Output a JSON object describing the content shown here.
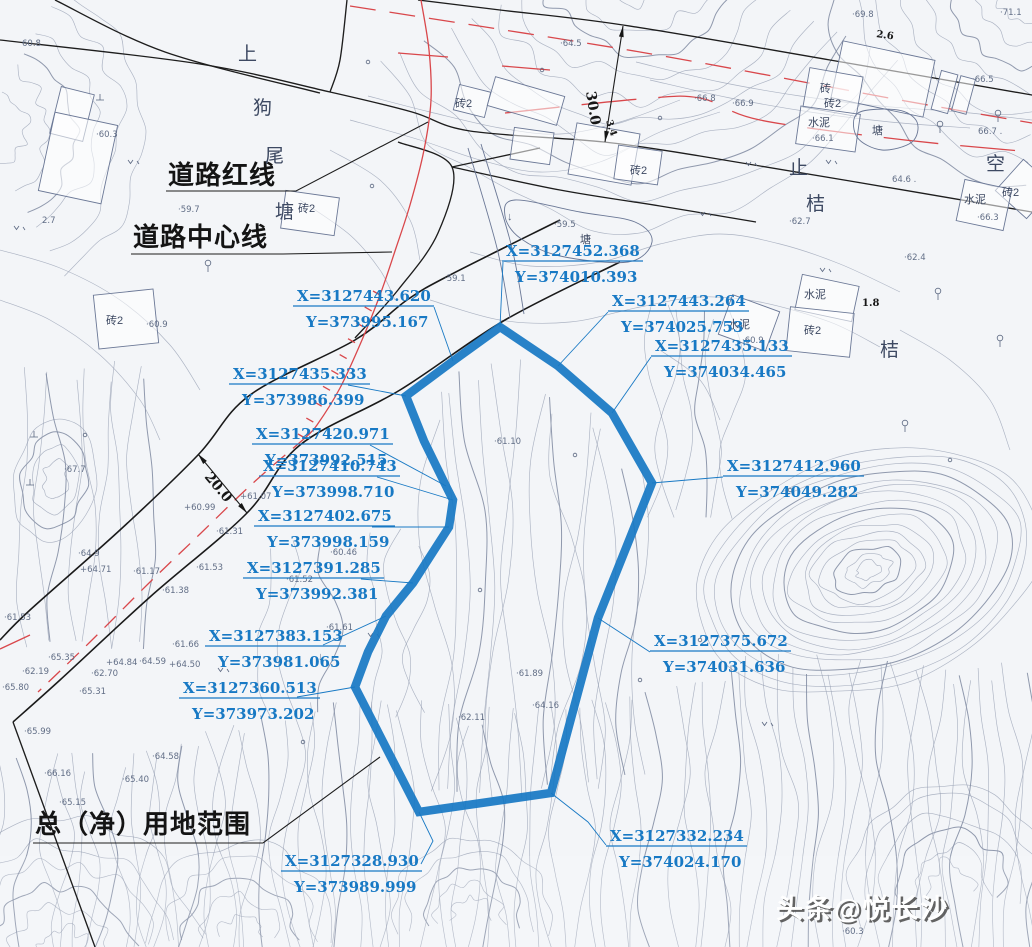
{
  "colors": {
    "accent_blue": "#1879c4",
    "red_line": "#d9474b",
    "black_line": "#1d1d1d",
    "contour": "#97a0b4"
  },
  "legend": {
    "road_red_line": "道路红线",
    "road_center_line": "道路中心线",
    "land_use_scope": "总（净）用地范围"
  },
  "place_name": [
    {
      "t": "上",
      "x": 238,
      "y": 60
    },
    {
      "t": "狗",
      "x": 253,
      "y": 114
    },
    {
      "t": "尾",
      "x": 265,
      "y": 162
    },
    {
      "t": "塘",
      "x": 275,
      "y": 218
    }
  ],
  "side_labels": [
    {
      "t": "止",
      "x": 789,
      "y": 174,
      "fs": 15
    },
    {
      "t": "桔",
      "x": 806,
      "y": 210,
      "fs": 15
    },
    {
      "t": "桔",
      "x": 880,
      "y": 356,
      "fs": 16
    },
    {
      "t": "空",
      "x": 986,
      "y": 170,
      "fs": 15
    }
  ],
  "watermark": "头条@悦长沙",
  "boundary": {
    "points": [
      [
        500,
        327
      ],
      [
        558,
        366
      ],
      [
        612,
        413
      ],
      [
        652,
        483
      ],
      [
        598,
        618
      ],
      [
        551,
        793
      ],
      [
        419,
        812
      ],
      [
        355,
        687
      ],
      [
        368,
        652
      ],
      [
        386,
        616
      ],
      [
        413,
        583
      ],
      [
        449,
        527
      ],
      [
        453,
        500
      ],
      [
        446,
        486
      ],
      [
        424,
        441
      ],
      [
        406,
        396
      ],
      [
        453,
        361
      ]
    ]
  },
  "coordinate_labels": [
    {
      "X": "X=3127452.368",
      "Y": "Y=374010.393",
      "x": 506,
      "y": 256,
      "leader": [
        [
          503,
          262
        ],
        [
          500,
          327
        ]
      ]
    },
    {
      "X": "X=3127443.620",
      "Y": "Y=373995.167",
      "x": 297,
      "y": 301,
      "leader": [
        [
          434,
          307
        ],
        [
          453,
          361
        ]
      ]
    },
    {
      "X": "X=3127443.264",
      "Y": "Y=374025.753",
      "x": 612,
      "y": 306,
      "leader": [
        [
          608,
          312
        ],
        [
          558,
          366
        ]
      ]
    },
    {
      "X": "X=3127435.133",
      "Y": "Y=374034.465",
      "x": 655,
      "y": 351,
      "leader": [
        [
          651,
          357
        ],
        [
          612,
          413
        ]
      ]
    },
    {
      "X": "X=3127435.333",
      "Y": "Y=373986.399",
      "x": 233,
      "y": 379,
      "leader": [
        [
          348,
          385
        ],
        [
          406,
          396
        ]
      ]
    },
    {
      "X": "X=3127420.971",
      "Y": "Y=373992.515",
      "x": 256,
      "y": 439,
      "leader": [
        [
          370,
          445
        ],
        [
          446,
          486
        ]
      ]
    },
    {
      "X": "X=3127410.743",
      "Y": "Y=373998.710",
      "x": 263,
      "y": 471,
      "leader": [
        [
          377,
          477
        ],
        [
          453,
          500
        ]
      ]
    },
    {
      "X": "X=3127402.675",
      "Y": "Y=373998.159",
      "x": 258,
      "y": 521,
      "leader": [
        [
          372,
          527
        ],
        [
          449,
          527
        ]
      ]
    },
    {
      "X": "X=3127391.285",
      "Y": "Y=373992.381",
      "x": 247,
      "y": 573,
      "leader": [
        [
          361,
          579
        ],
        [
          413,
          583
        ]
      ]
    },
    {
      "X": "X=3127412.960",
      "Y": "Y=374049.282",
      "x": 727,
      "y": 471,
      "leader": [
        [
          723,
          477
        ],
        [
          652,
          483
        ]
      ]
    },
    {
      "X": "X=3127383.153",
      "Y": "Y=373981.065",
      "x": 209,
      "y": 641,
      "leader": [
        [
          323,
          645
        ],
        [
          386,
          616
        ]
      ]
    },
    {
      "X": "X=3127360.513",
      "Y": "Y=373973.202",
      "x": 183,
      "y": 693,
      "leader": [
        [
          297,
          697
        ],
        [
          355,
          687
        ]
      ]
    },
    {
      "X": "X=3127375.672",
      "Y": "Y=374031.636",
      "x": 654,
      "y": 646,
      "leader": [
        [
          650,
          652
        ],
        [
          598,
          618
        ]
      ]
    },
    {
      "X": "X=3127328.930",
      "Y": "Y=373989.999",
      "x": 285,
      "y": 866,
      "leader": [
        [
          421,
          864
        ],
        [
          433,
          841
        ],
        [
          419,
          812
        ]
      ]
    },
    {
      "X": "X=3127332.234",
      "Y": "Y=374024.170",
      "x": 610,
      "y": 841,
      "leader": [
        [
          606,
          845
        ],
        [
          588,
          822
        ],
        [
          551,
          793
        ]
      ]
    }
  ],
  "dimensions": [
    {
      "text": "30.0",
      "line": [
        [
          623,
          26
        ],
        [
          605,
          142
        ]
      ],
      "tx": 586,
      "ty": 92,
      "rot": 81,
      "fs": 14
    },
    {
      "text": "20.0",
      "line": [
        [
          198,
          454
        ],
        [
          247,
          513
        ]
      ],
      "tx": 204,
      "ty": 477,
      "rot": 50,
      "fs": 14
    },
    {
      "text": "3.4",
      "tx": 606,
      "ty": 121,
      "rot": 72,
      "fs": 9.5
    },
    {
      "text": "1.8",
      "tx": 862,
      "ty": 306,
      "rot": 0,
      "fs": 10
    },
    {
      "text": "2.6",
      "tx": 876,
      "ty": 37,
      "rot": 8,
      "fs": 10
    }
  ],
  "spot_elevations": [
    {
      "x": 22,
      "y": 46,
      "t": "60.8"
    },
    {
      "x": 96,
      "y": 137,
      "t": "·60.3"
    },
    {
      "x": 178,
      "y": 212,
      "t": "·59.7"
    },
    {
      "x": 42,
      "y": 223,
      "t": "2.7"
    },
    {
      "x": 146,
      "y": 327,
      "t": "·60.9"
    },
    {
      "x": 444,
      "y": 281,
      "t": "·59.1"
    },
    {
      "x": 554,
      "y": 227,
      "t": "·59.5"
    },
    {
      "x": 560,
      "y": 46,
      "t": "·64.5"
    },
    {
      "x": 852,
      "y": 17,
      "t": "·69.8"
    },
    {
      "x": 1000,
      "y": 15,
      "t": "·71.1"
    },
    {
      "x": 694,
      "y": 101,
      "t": "·66.8"
    },
    {
      "x": 732,
      "y": 106,
      "t": "·66.9"
    },
    {
      "x": 972,
      "y": 82,
      "t": "·66.5"
    },
    {
      "x": 978,
      "y": 134,
      "t": "66.7 ."
    },
    {
      "x": 812,
      "y": 141,
      "t": "·66.1"
    },
    {
      "x": 977,
      "y": 220,
      "t": "·66.3"
    },
    {
      "x": 892,
      "y": 182,
      "t": "64.6 ."
    },
    {
      "x": 789,
      "y": 224,
      "t": "·62.7"
    },
    {
      "x": 904,
      "y": 260,
      "t": "·62.4"
    },
    {
      "x": 742,
      "y": 343,
      "t": "·60.9"
    },
    {
      "x": 64,
      "y": 472,
      "t": "·67.7"
    },
    {
      "x": 78,
      "y": 556,
      "t": "·64.9"
    },
    {
      "x": 80,
      "y": 572,
      "t": "+64.71"
    },
    {
      "x": 133,
      "y": 574,
      "t": "·61.17"
    },
    {
      "x": 240,
      "y": 499,
      "t": "+61.07"
    },
    {
      "x": 184,
      "y": 510,
      "t": "+60.99"
    },
    {
      "x": 216,
      "y": 534,
      "t": "·61.31"
    },
    {
      "x": 196,
      "y": 570,
      "t": "·61.53"
    },
    {
      "x": 162,
      "y": 593,
      "t": "·61.38"
    },
    {
      "x": 4,
      "y": 620,
      "t": "·61.53"
    },
    {
      "x": 286,
      "y": 582,
      "t": "·61.52"
    },
    {
      "x": 330,
      "y": 555,
      "t": "·60.46"
    },
    {
      "x": 172,
      "y": 647,
      "t": "·61.66"
    },
    {
      "x": 106,
      "y": 665,
      "t": "+64.84"
    },
    {
      "x": 139,
      "y": 664,
      "t": "·64.59"
    },
    {
      "x": 169,
      "y": 667,
      "t": "+64.50"
    },
    {
      "x": 48,
      "y": 660,
      "t": "·65.35"
    },
    {
      "x": 2,
      "y": 690,
      "t": "·65.80"
    },
    {
      "x": 79,
      "y": 694,
      "t": "·65.31"
    },
    {
      "x": 24,
      "y": 734,
      "t": "·65.99"
    },
    {
      "x": 44,
      "y": 776,
      "t": "·66.16"
    },
    {
      "x": 152,
      "y": 759,
      "t": "·64.58"
    },
    {
      "x": 122,
      "y": 782,
      "t": "·65.40"
    },
    {
      "x": 59,
      "y": 805,
      "t": "·65.15"
    },
    {
      "x": 326,
      "y": 630,
      "t": "·61.61"
    },
    {
      "x": 516,
      "y": 676,
      "t": "·61.89"
    },
    {
      "x": 458,
      "y": 720,
      "t": "·62.11"
    },
    {
      "x": 22,
      "y": 674,
      "t": "·62.19"
    },
    {
      "x": 91,
      "y": 676,
      "t": "·62.70"
    },
    {
      "x": 532,
      "y": 708,
      "t": "·64.16"
    },
    {
      "x": 494,
      "y": 444,
      "t": "·61.10"
    },
    {
      "x": 842,
      "y": 934,
      "t": "·60.3"
    }
  ],
  "feature_labels": [
    {
      "t": "塘",
      "x": 872,
      "y": 134,
      "fs": 13
    },
    {
      "t": "塘",
      "x": 580,
      "y": 243,
      "fs": 13
    },
    {
      "t": "砖",
      "x": 820,
      "y": 92,
      "fs": 11
    },
    {
      "t": "砖2",
      "x": 824,
      "y": 107,
      "fs": 11
    },
    {
      "t": "砖2",
      "x": 455,
      "y": 107,
      "fs": 11
    },
    {
      "t": "砖2",
      "x": 630,
      "y": 174,
      "fs": 11
    },
    {
      "t": "砖2",
      "x": 1002,
      "y": 196,
      "fs": 11
    },
    {
      "t": "砖2",
      "x": 298,
      "y": 212,
      "fs": 11
    },
    {
      "t": "砖2",
      "x": 106,
      "y": 324,
      "fs": 11
    },
    {
      "t": "水泥",
      "x": 808,
      "y": 126,
      "fs": 11
    },
    {
      "t": "水泥",
      "x": 964,
      "y": 203,
      "fs": 11
    },
    {
      "t": "水泥",
      "x": 728,
      "y": 328,
      "fs": 11
    },
    {
      "t": "水泥",
      "x": 804,
      "y": 298,
      "fs": 11
    },
    {
      "t": "砖2",
      "x": 804,
      "y": 334,
      "fs": 11
    }
  ],
  "symbols": {
    "trees": [
      [
        940,
        129
      ],
      [
        998,
        118
      ],
      [
        938,
        296
      ],
      [
        1000,
        343
      ],
      [
        905,
        428
      ],
      [
        208,
        268
      ]
    ],
    "grass": [
      [
        128,
        160
      ],
      [
        14,
        226
      ],
      [
        746,
        162
      ],
      [
        700,
        212
      ],
      [
        820,
        268
      ],
      [
        368,
        633
      ],
      [
        218,
        668
      ],
      [
        762,
        722
      ],
      [
        826,
        160
      ]
    ],
    "arrows": [
      [
        507,
        220
      ],
      [
        318,
        660
      ]
    ],
    "tmarks": [
      [
        100,
        100
      ],
      [
        34,
        437
      ],
      [
        30,
        485
      ]
    ],
    "dots": [
      [
        368,
        62
      ],
      [
        542,
        70
      ],
      [
        372,
        186
      ],
      [
        85,
        435
      ],
      [
        660,
        118
      ],
      [
        303,
        742
      ],
      [
        575,
        455
      ],
      [
        640,
        680
      ],
      [
        950,
        460
      ],
      [
        790,
        490
      ],
      [
        480,
        590
      ],
      [
        700,
        640
      ]
    ]
  },
  "map_lines": {
    "black": [
      [
        [
          0,
          40
        ],
        [
          200,
          64
        ],
        [
          330,
          92
        ],
        [
          412,
          112
        ],
        [
          470,
          131
        ],
        [
          604,
          142
        ],
        [
          700,
          156
        ],
        [
          850,
          181
        ],
        [
          1032,
          212
        ]
      ],
      [
        [
          418,
          0
        ],
        [
          500,
          10
        ],
        [
          623,
          25
        ],
        [
          830,
          60
        ],
        [
          1032,
          95
        ]
      ],
      [
        [
          55,
          0
        ],
        [
          165,
          52
        ],
        [
          320,
          93
        ]
      ],
      [
        [
          347,
          0
        ],
        [
          340,
          60
        ],
        [
          330,
          92
        ]
      ],
      [
        [
          398,
          142
        ],
        [
          452,
          167
        ],
        [
          438,
          233
        ],
        [
          398,
          290
        ],
        [
          355,
          338
        ]
      ],
      [
        [
          452,
          167
        ],
        [
          540,
          148
        ]
      ],
      [
        [
          452,
          167
        ],
        [
          560,
          190
        ],
        [
          660,
          206
        ],
        [
          756,
          222
        ]
      ],
      [
        [
          560,
          220
        ],
        [
          450,
          275
        ],
        [
          407,
          300
        ],
        [
          355,
          340
        ],
        [
          250,
          395
        ],
        [
          198,
          455
        ],
        [
          120,
          530
        ],
        [
          30,
          610
        ],
        [
          0,
          640
        ]
      ],
      [
        [
          620,
          262
        ],
        [
          505,
          320
        ],
        [
          400,
          390
        ],
        [
          300,
          445
        ],
        [
          247,
          513
        ],
        [
          150,
          597
        ],
        [
          60,
          680
        ],
        [
          13,
          722
        ]
      ],
      [
        [
          13,
          722
        ],
        [
          95,
          947
        ]
      ]
    ],
    "red": [
      {
        "pts": [
          [
            350,
            6
          ],
          [
            640,
            52
          ],
          [
            900,
            100
          ],
          [
            1032,
            123
          ]
        ],
        "dash": "26 14"
      },
      {
        "pts": [
          [
            505,
            113
          ],
          [
            640,
            99
          ],
          [
            700,
            98
          ],
          [
            760,
            120
          ],
          [
            905,
            140
          ],
          [
            1032,
            152
          ]
        ],
        "dash": "55 22"
      },
      {
        "pts": [
          [
            421,
            0
          ],
          [
            429,
            50
          ],
          [
            431,
            100
          ],
          [
            424,
            150
          ],
          [
            410,
            205
          ],
          [
            396,
            248
          ],
          [
            380,
            295
          ],
          [
            362,
            340
          ],
          [
            340,
            388
          ],
          [
            317,
            425
          ],
          [
            305,
            438
          ]
        ],
        "dash": ""
      },
      {
        "pts": [
          [
            305,
            438
          ],
          [
            252,
            484
          ],
          [
            200,
            534
          ],
          [
            148,
            584
          ],
          [
            90,
            642
          ],
          [
            38,
            692
          ]
        ],
        "dash": "16 10"
      },
      {
        "pts": [
          [
            398,
            53
          ],
          [
            448,
            57
          ]
        ],
        "dash": ""
      },
      {
        "pts": [
          [
            502,
            66
          ],
          [
            550,
            70
          ]
        ],
        "dash": ""
      },
      {
        "pts": [
          [
            0,
            649
          ],
          [
            30,
            635
          ]
        ],
        "dash": ""
      }
    ]
  },
  "buildings": [
    [
      55,
      90,
      34,
      48,
      14
    ],
    [
      46,
      118,
      64,
      80,
      12
    ],
    [
      96,
      292,
      60,
      54,
      -6
    ],
    [
      283,
      194,
      54,
      38,
      8
    ],
    [
      456,
      88,
      32,
      26,
      14
    ],
    [
      490,
      86,
      72,
      30,
      16
    ],
    [
      512,
      130,
      40,
      32,
      8
    ],
    [
      572,
      128,
      64,
      52,
      10
    ],
    [
      616,
      148,
      44,
      34,
      8
    ],
    [
      836,
      50,
      94,
      58,
      12
    ],
    [
      806,
      72,
      54,
      40,
      10
    ],
    [
      798,
      110,
      60,
      38,
      8
    ],
    [
      936,
      72,
      17,
      40,
      15
    ],
    [
      956,
      77,
      15,
      36,
      15
    ],
    [
      1004,
      168,
      42,
      42,
      42
    ],
    [
      960,
      184,
      48,
      42,
      12
    ],
    [
      798,
      280,
      58,
      36,
      12
    ],
    [
      788,
      310,
      64,
      44,
      6
    ],
    [
      724,
      302,
      50,
      42,
      20
    ]
  ],
  "ponds": [
    [
      [
        515,
        200
      ],
      [
        580,
        212
      ],
      [
        635,
        222
      ],
      [
        652,
        242
      ],
      [
        628,
        262
      ],
      [
        560,
        256
      ],
      [
        520,
        238
      ],
      [
        505,
        216
      ]
    ],
    [
      [
        858,
        113
      ],
      [
        898,
        110
      ],
      [
        917,
        122
      ],
      [
        912,
        142
      ],
      [
        882,
        150
      ],
      [
        857,
        137
      ]
    ]
  ],
  "channel": [
    [
      [
        468,
        148
      ],
      [
        497,
        248
      ],
      [
        510,
        318
      ]
    ],
    [
      [
        481,
        144
      ],
      [
        511,
        244
      ],
      [
        524,
        314
      ]
    ]
  ]
}
